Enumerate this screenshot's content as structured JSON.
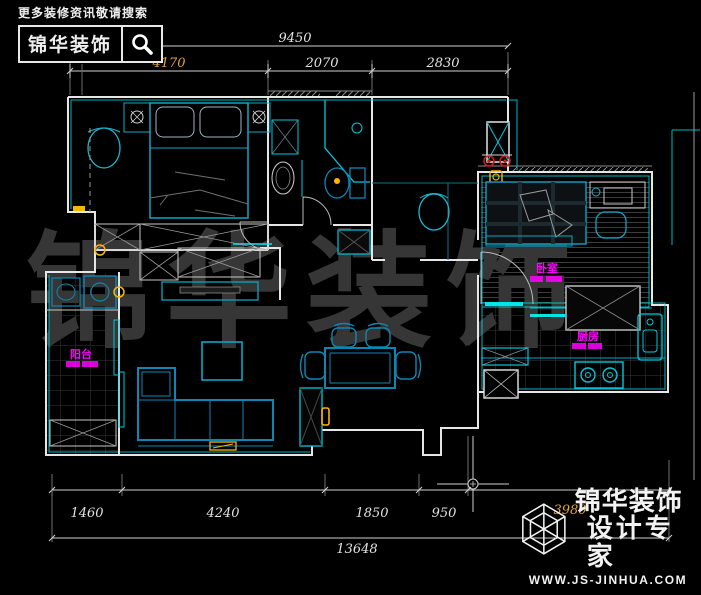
{
  "header": {
    "search_hint": "更多装修资讯敬请搜索",
    "logo_text": "锦华装饰"
  },
  "watermark": {
    "text": "锦华装饰"
  },
  "dimensions": {
    "top": {
      "total": "9450",
      "segments": [
        {
          "label": "4170",
          "color": "#e2a23c"
        },
        {
          "label": "2070",
          "color": "#e2e2e2"
        },
        {
          "label": "2830",
          "color": "#e2e2e2"
        }
      ]
    },
    "bottom": {
      "segments": [
        {
          "label": "1460",
          "color": "#e2e2e2"
        },
        {
          "label": "4240",
          "color": "#e2e2e2"
        },
        {
          "label": "1850",
          "color": "#e2e2e2"
        },
        {
          "label": "950",
          "color": "#e2e2e2"
        },
        {
          "label": "3980",
          "color": "#e2a23c"
        }
      ],
      "total": "13648"
    }
  },
  "room_labels": {
    "bedroom2": "卧室",
    "kitchen": "厨房",
    "balcony": "阳台"
  },
  "footer_logo": {
    "brand": "锦华装饰",
    "tagline": "设计专家",
    "url": "WWW.JS-JINHUA.COM"
  },
  "colors": {
    "wall_white": "#e6e6e6",
    "accent_cyan": "#00d5e8",
    "furniture_blue": "#0e86b4",
    "label_magenta": "#ff00ff",
    "dim_orange": "#e2a23c",
    "outlet_red": "#d01818",
    "switch_yellow": "#ffb400",
    "watermark_gray": "#363636"
  }
}
